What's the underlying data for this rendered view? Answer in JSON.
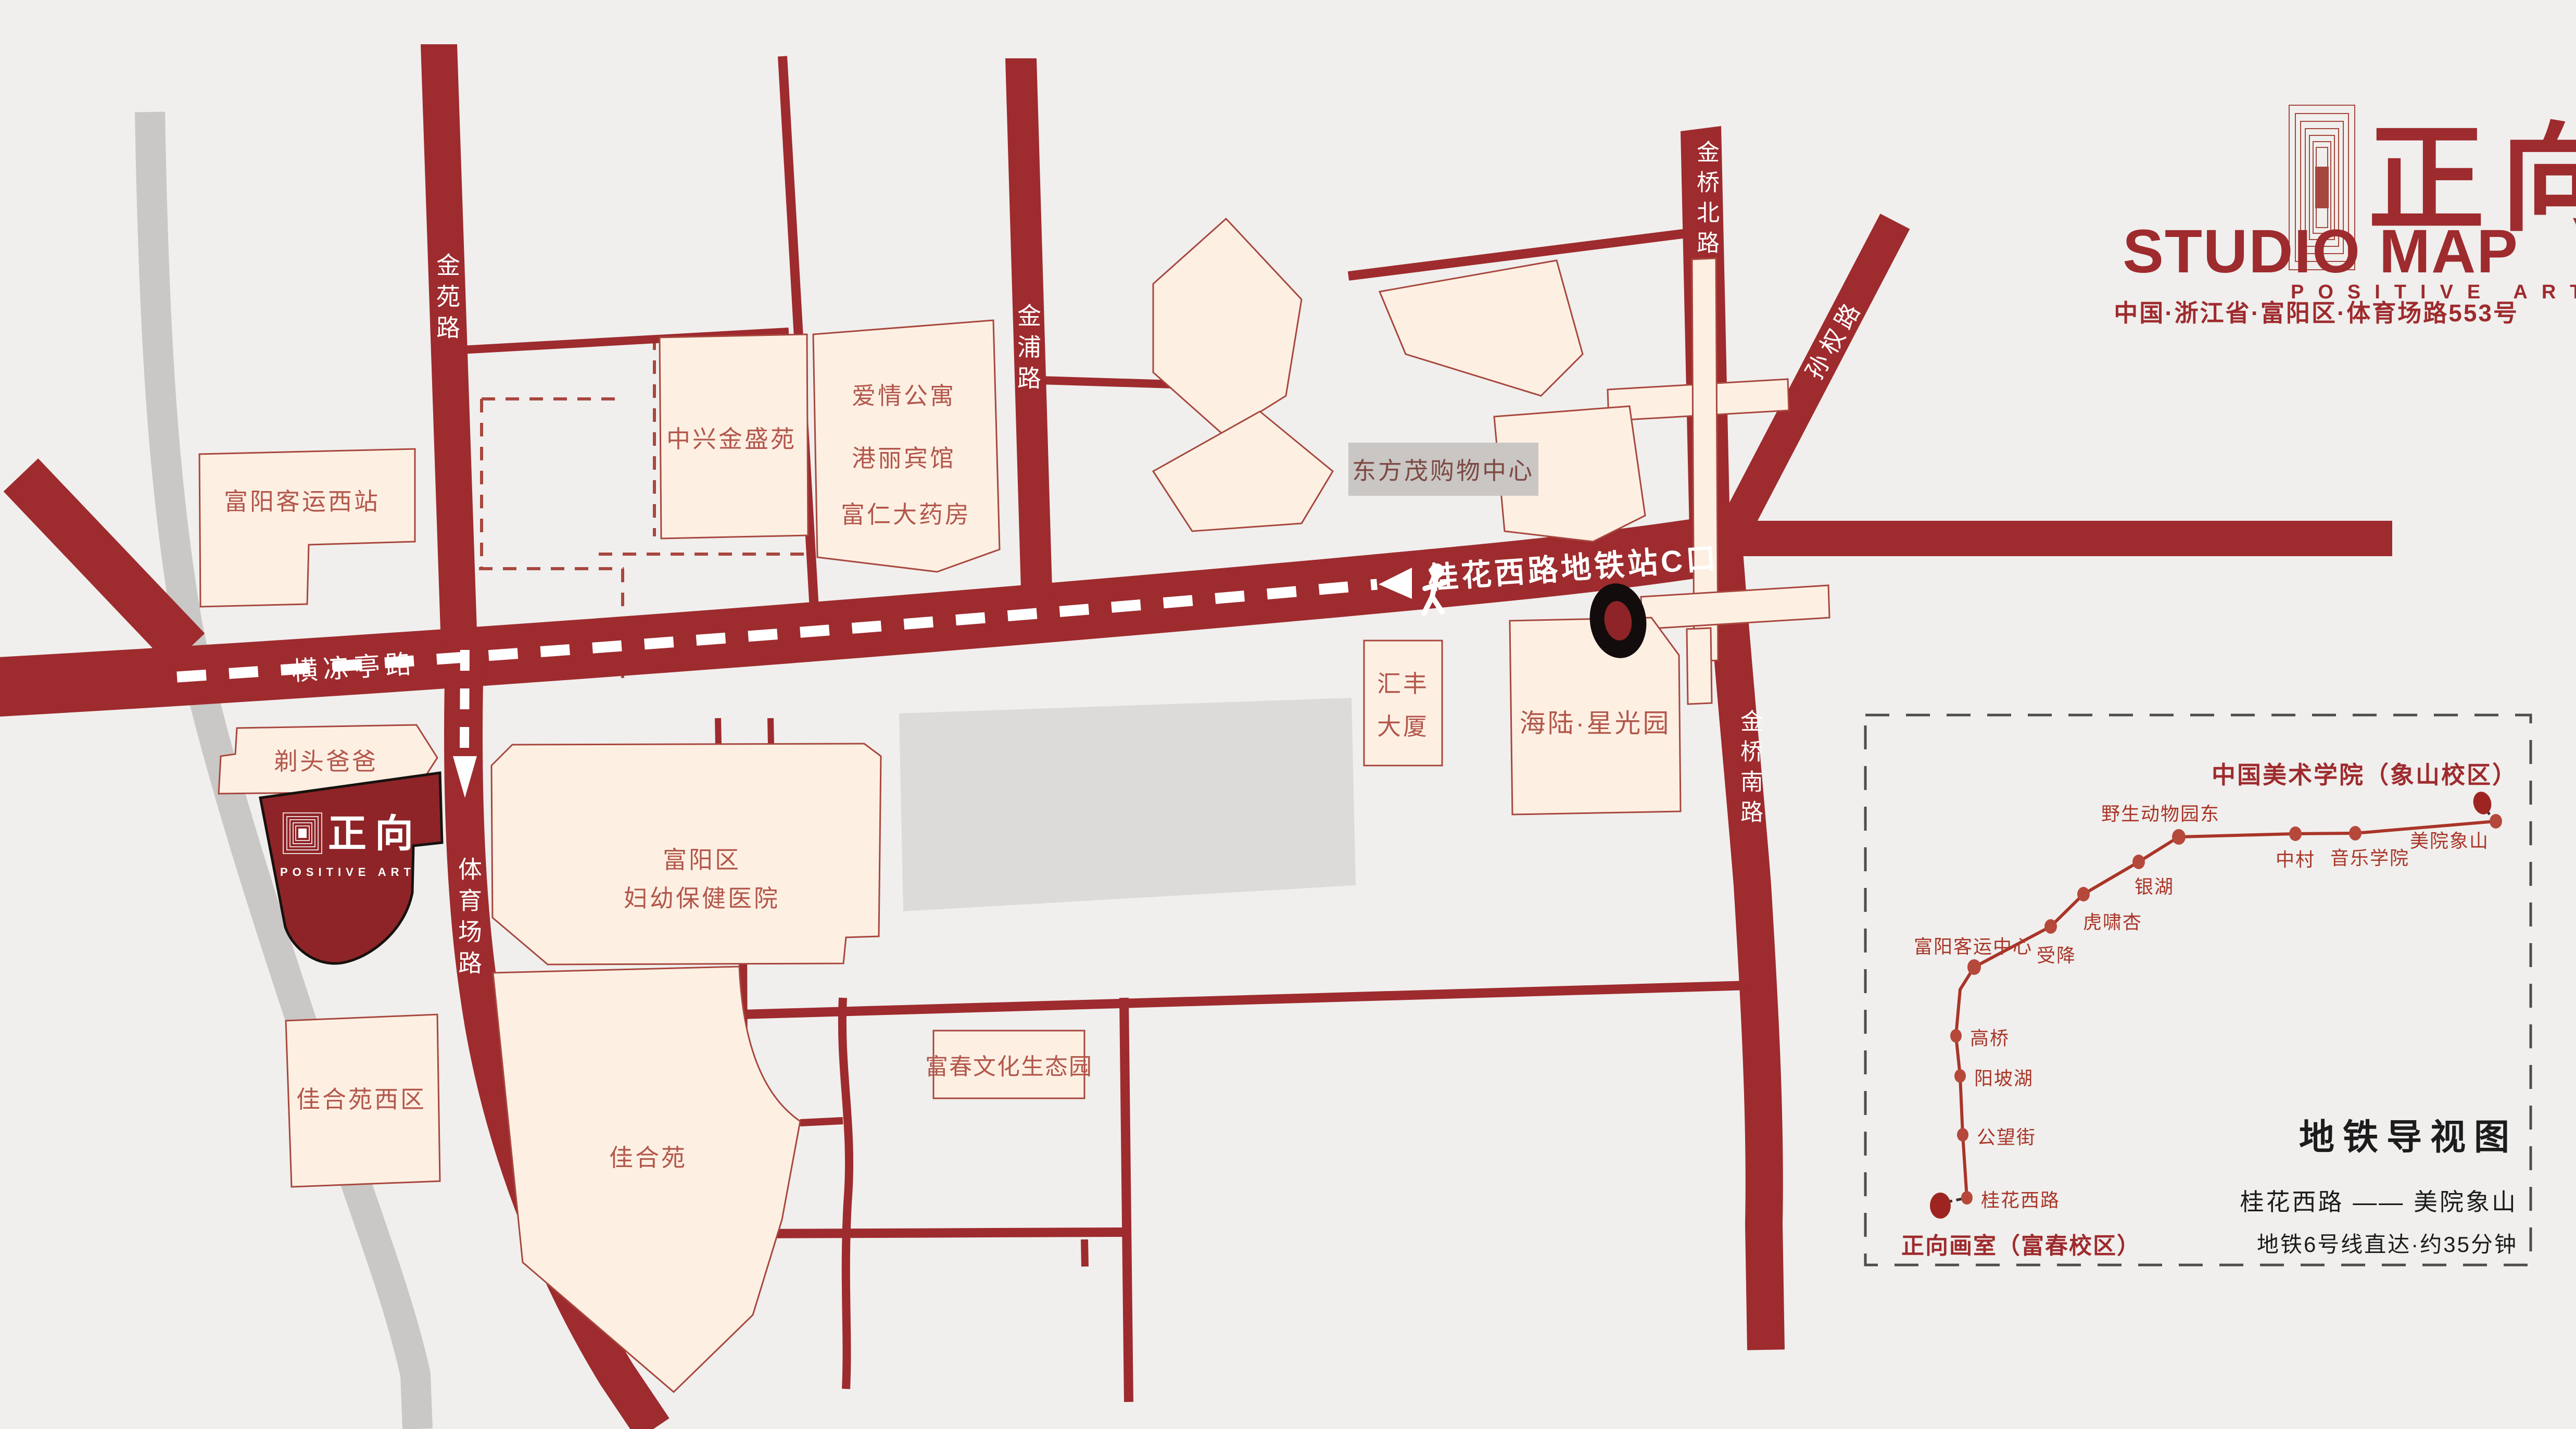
{
  "header": {
    "logo_text": "正向",
    "logo_subtext": "POSITIVE ART",
    "title": "STUDIO MAP",
    "address": "中国·浙江省·富阳区·体育场路553号"
  },
  "map": {
    "roads": {
      "jinyuan": "金苑路",
      "jinpu": "金浦路",
      "jinqiao_north": "金桥北路",
      "jinqiao_south": "金桥南路",
      "sunquan": "孙权路",
      "hengliangting": "横凉亭路",
      "tiyuchang": "体育场路"
    },
    "walk_label": "桂花西路地铁站C口",
    "buildings": {
      "fuyang_west_station": "富阳客运西站",
      "zhongxing": "中兴金盛苑",
      "aiqing": "爱情公寓",
      "gangli": "港丽宾馆",
      "furen": "富仁大药房",
      "dongfangmao": "东方茂购物中心",
      "huifeng_l1": "汇丰",
      "huifeng_l2": "大厦",
      "hailu": "海陆·星光园",
      "titou": "剃头爸爸",
      "hospital_l1": "富阳区",
      "hospital_l2": "妇幼保健医院",
      "jiaheyuan_west": "佳合苑西区",
      "jiaheyuan": "佳合苑",
      "fuchun_park": "富春文化生态园"
    },
    "studio": {
      "logo_text": "正向",
      "logo_subtext": "POSITIVE ART"
    }
  },
  "subway": {
    "dest_title": "中国美术学院（象山校区）",
    "origin_label": "正向画室（富春校区）",
    "stations": [
      "桂花西路",
      "公望街",
      "阳坡湖",
      "高桥",
      "富阳客运中心",
      "受降",
      "虎啸杏",
      "银湖",
      "野生动物园东",
      "中村",
      "音乐学院",
      "美院象山"
    ],
    "panel_title": "地铁导视图",
    "route": "桂花西路 —— 美院象山",
    "note": "地铁6号线直达·约35分钟"
  },
  "colors": {
    "background": "#f0efed",
    "road_red": "#9e2b2e",
    "building_fill": "#fdf0e3",
    "building_stroke": "#a8473e",
    "building_text": "#b3574c",
    "studio_fill": "#8e2427",
    "gray_road": "#c9c8c6",
    "gray_block": "#dcdbd9",
    "metro_line": "#a93528",
    "panel_border": "#4d4d4d"
  }
}
